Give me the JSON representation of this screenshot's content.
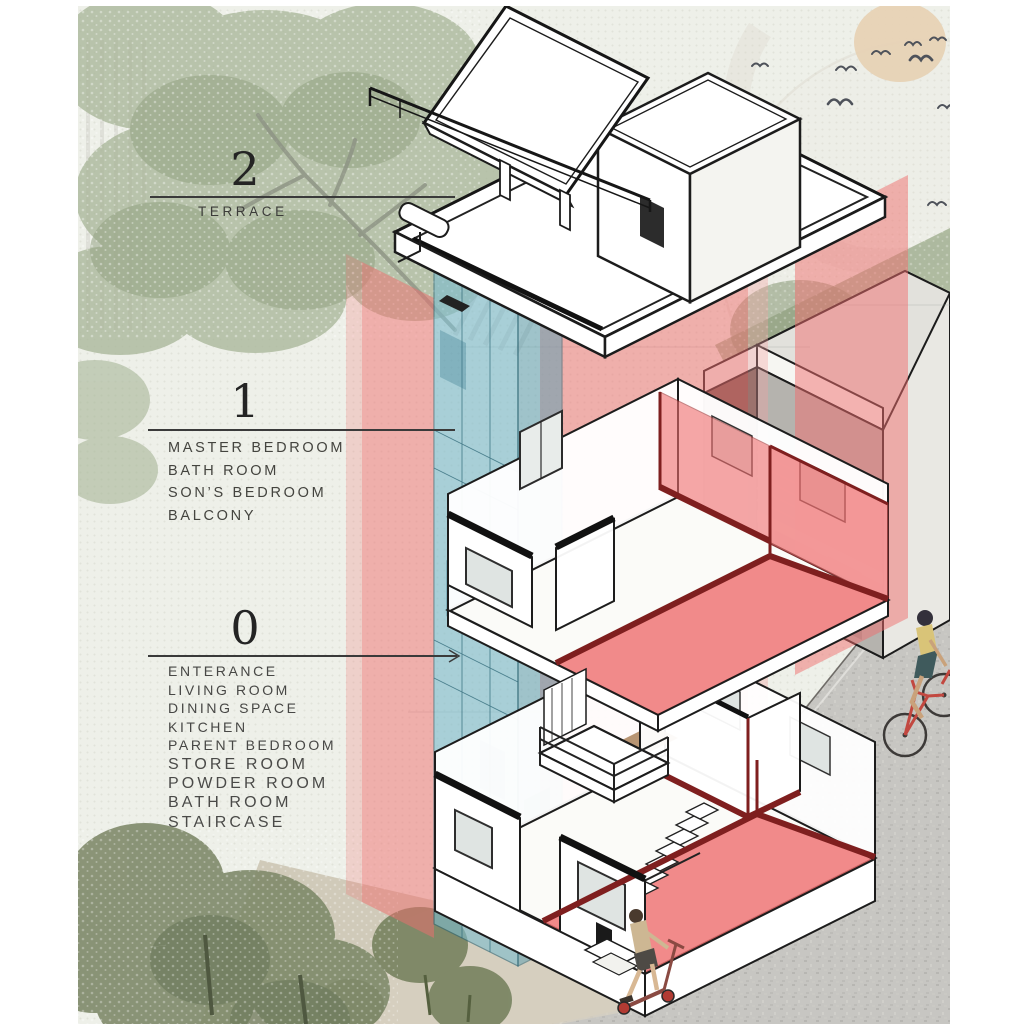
{
  "title": "Exploded axonometric diagram of a narrow three-storey house",
  "palette": {
    "paper": "#eef0e9",
    "overlay_red": "#ef6e6e",
    "overlay_blue": "#7ebccd",
    "wall_maroon": "#7f1f1f",
    "ink": "#1c1c1c",
    "label_text": "#474745",
    "tree_sage": "#a7b597",
    "tree_olive": "#77825f",
    "street_grey": "#c7c6c2",
    "ground_beige": "#d0cab9",
    "sun_tan": "#e7d2b5",
    "bike_red": "#c24840",
    "scooter_red": "#b23b33"
  },
  "levels": [
    {
      "id": "2",
      "label_number": "2",
      "rooms": [
        "TERRACE"
      ]
    },
    {
      "id": "1",
      "label_number": "1",
      "rooms": [
        "MASTER BEDROOM",
        "BATH ROOM",
        "SON’S BEDROOM",
        "BALCONY"
      ]
    },
    {
      "id": "0",
      "label_number": "0",
      "rooms": [
        "ENTERANCE",
        "LIVING ROOM",
        "DINING SPACE",
        "KITCHEN",
        "PARENT BEDROOM",
        "STORE ROOM",
        "POWDER ROOM",
        "BATH ROOM",
        "STAIRCASE"
      ]
    }
  ],
  "scene": {
    "icons": [
      "sun-icon",
      "birds-icon",
      "tree-icon",
      "neighbor-building",
      "street",
      "cyclist-figure",
      "scooter-rider-figure",
      "exploded-house",
      "red-section-planes",
      "blue-stair-core",
      "balcony",
      "roof-canopy",
      "leader-lines"
    ]
  }
}
